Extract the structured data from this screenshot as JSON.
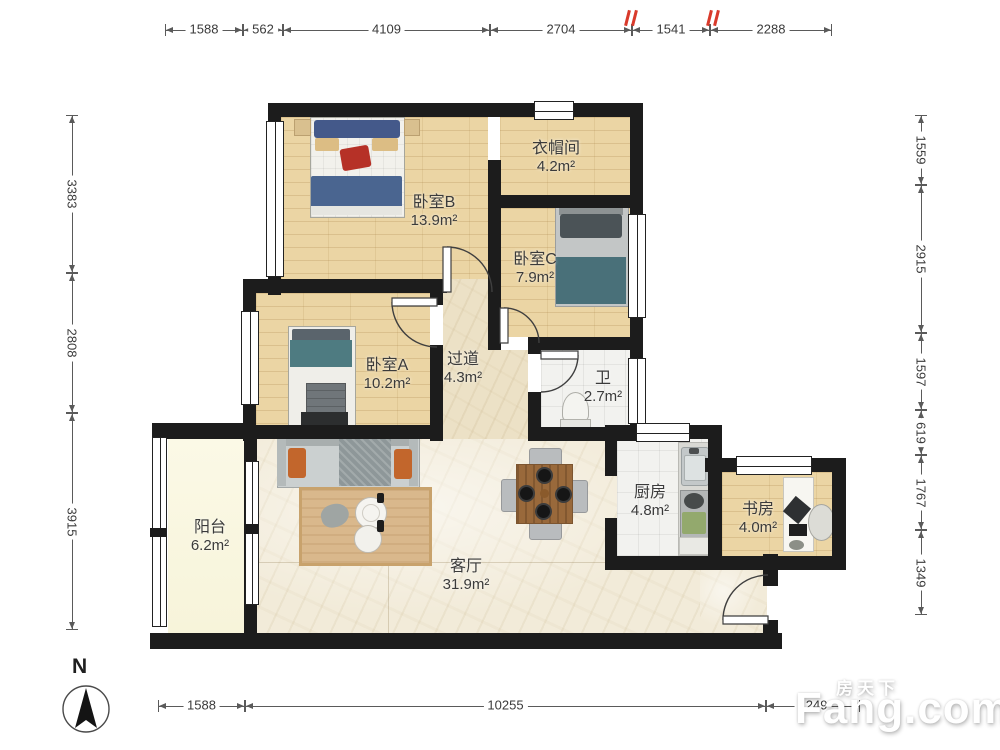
{
  "plan": {
    "rooms": [
      {
        "id": "bedroom-b",
        "name": "卧室B",
        "area": "13.9m²"
      },
      {
        "id": "cloakroom",
        "name": "衣帽间",
        "area": "4.2m²"
      },
      {
        "id": "bedroom-c",
        "name": "卧室C",
        "area": "7.9m²"
      },
      {
        "id": "bedroom-a",
        "name": "卧室A",
        "area": "10.2m²"
      },
      {
        "id": "hallway",
        "name": "过道",
        "area": "4.3m²"
      },
      {
        "id": "bathroom",
        "name": "卫",
        "area": "2.7m²"
      },
      {
        "id": "balcony",
        "name": "阳台",
        "area": "6.2m²"
      },
      {
        "id": "living-room",
        "name": "客厅",
        "area": "31.9m²"
      },
      {
        "id": "kitchen",
        "name": "厨房",
        "area": "4.8m²"
      },
      {
        "id": "study",
        "name": "书房",
        "area": "4.0m²"
      }
    ]
  },
  "dimensions": {
    "top": [
      "1588",
      "562",
      "4109",
      "2704",
      "1541",
      "2288"
    ],
    "left": [
      "3383",
      "2808",
      "3915"
    ],
    "right": [
      "1559",
      "2915",
      "1597",
      "619",
      "1767",
      "1349"
    ],
    "bottom": [
      "1588",
      "10255",
      "1249"
    ]
  },
  "compass": {
    "label": "N"
  },
  "watermark": {
    "cn": "房天下",
    "en": "Fang.com"
  },
  "colors": {
    "wall": "#1c1c1c",
    "wood": "#ebd5a4",
    "marble": "#f2ebd9",
    "tile": "#f2f2ef",
    "balcony": "#fbf9e6",
    "accent_red": "#d93a2b",
    "teal": "#4e7b81",
    "navy": "#44598a"
  }
}
